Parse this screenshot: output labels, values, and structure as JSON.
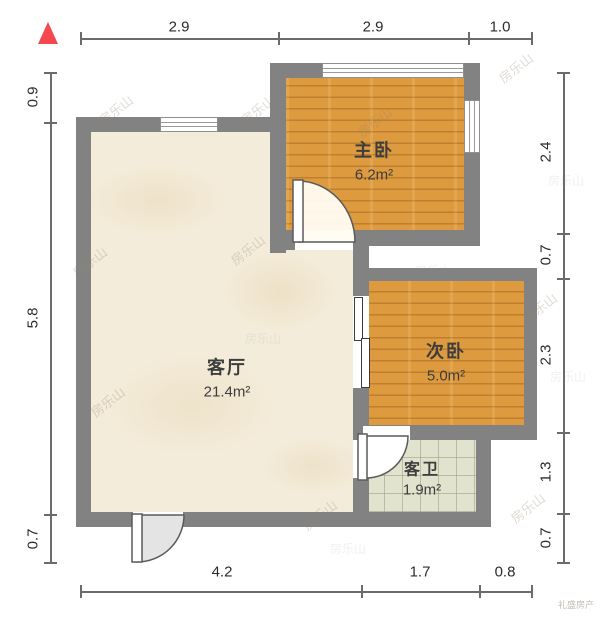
{
  "plan": {
    "rooms": [
      {
        "name": "客厅",
        "area": "21.4m²"
      },
      {
        "name": "主卧",
        "area": "6.2m²"
      },
      {
        "name": "次卧",
        "area": "5.0m²"
      },
      {
        "name": "客卫",
        "area": "1.9m²"
      }
    ],
    "dimensions_m": {
      "top": [
        "2.9",
        "2.9",
        "1.0"
      ],
      "bottom": [
        "4.2",
        "1.7",
        "0.8"
      ],
      "left": [
        "0.9",
        "5.8",
        "0.7"
      ],
      "right": [
        "2.4",
        "0.7",
        "2.3",
        "1.3",
        "0.7"
      ]
    }
  },
  "watermark": {
    "text": "房乐山",
    "brand": "礼盛房产"
  },
  "icons": {
    "north_arrow": "north-arrow"
  },
  "colors": {
    "wall": "#828282",
    "wood_floor": "#dd9a3f",
    "living_floor": "#f4ecda",
    "bath_floor": "#e1e3cf",
    "north_arrow": "#f4484e",
    "dimension_line": "#6b6b6b"
  }
}
